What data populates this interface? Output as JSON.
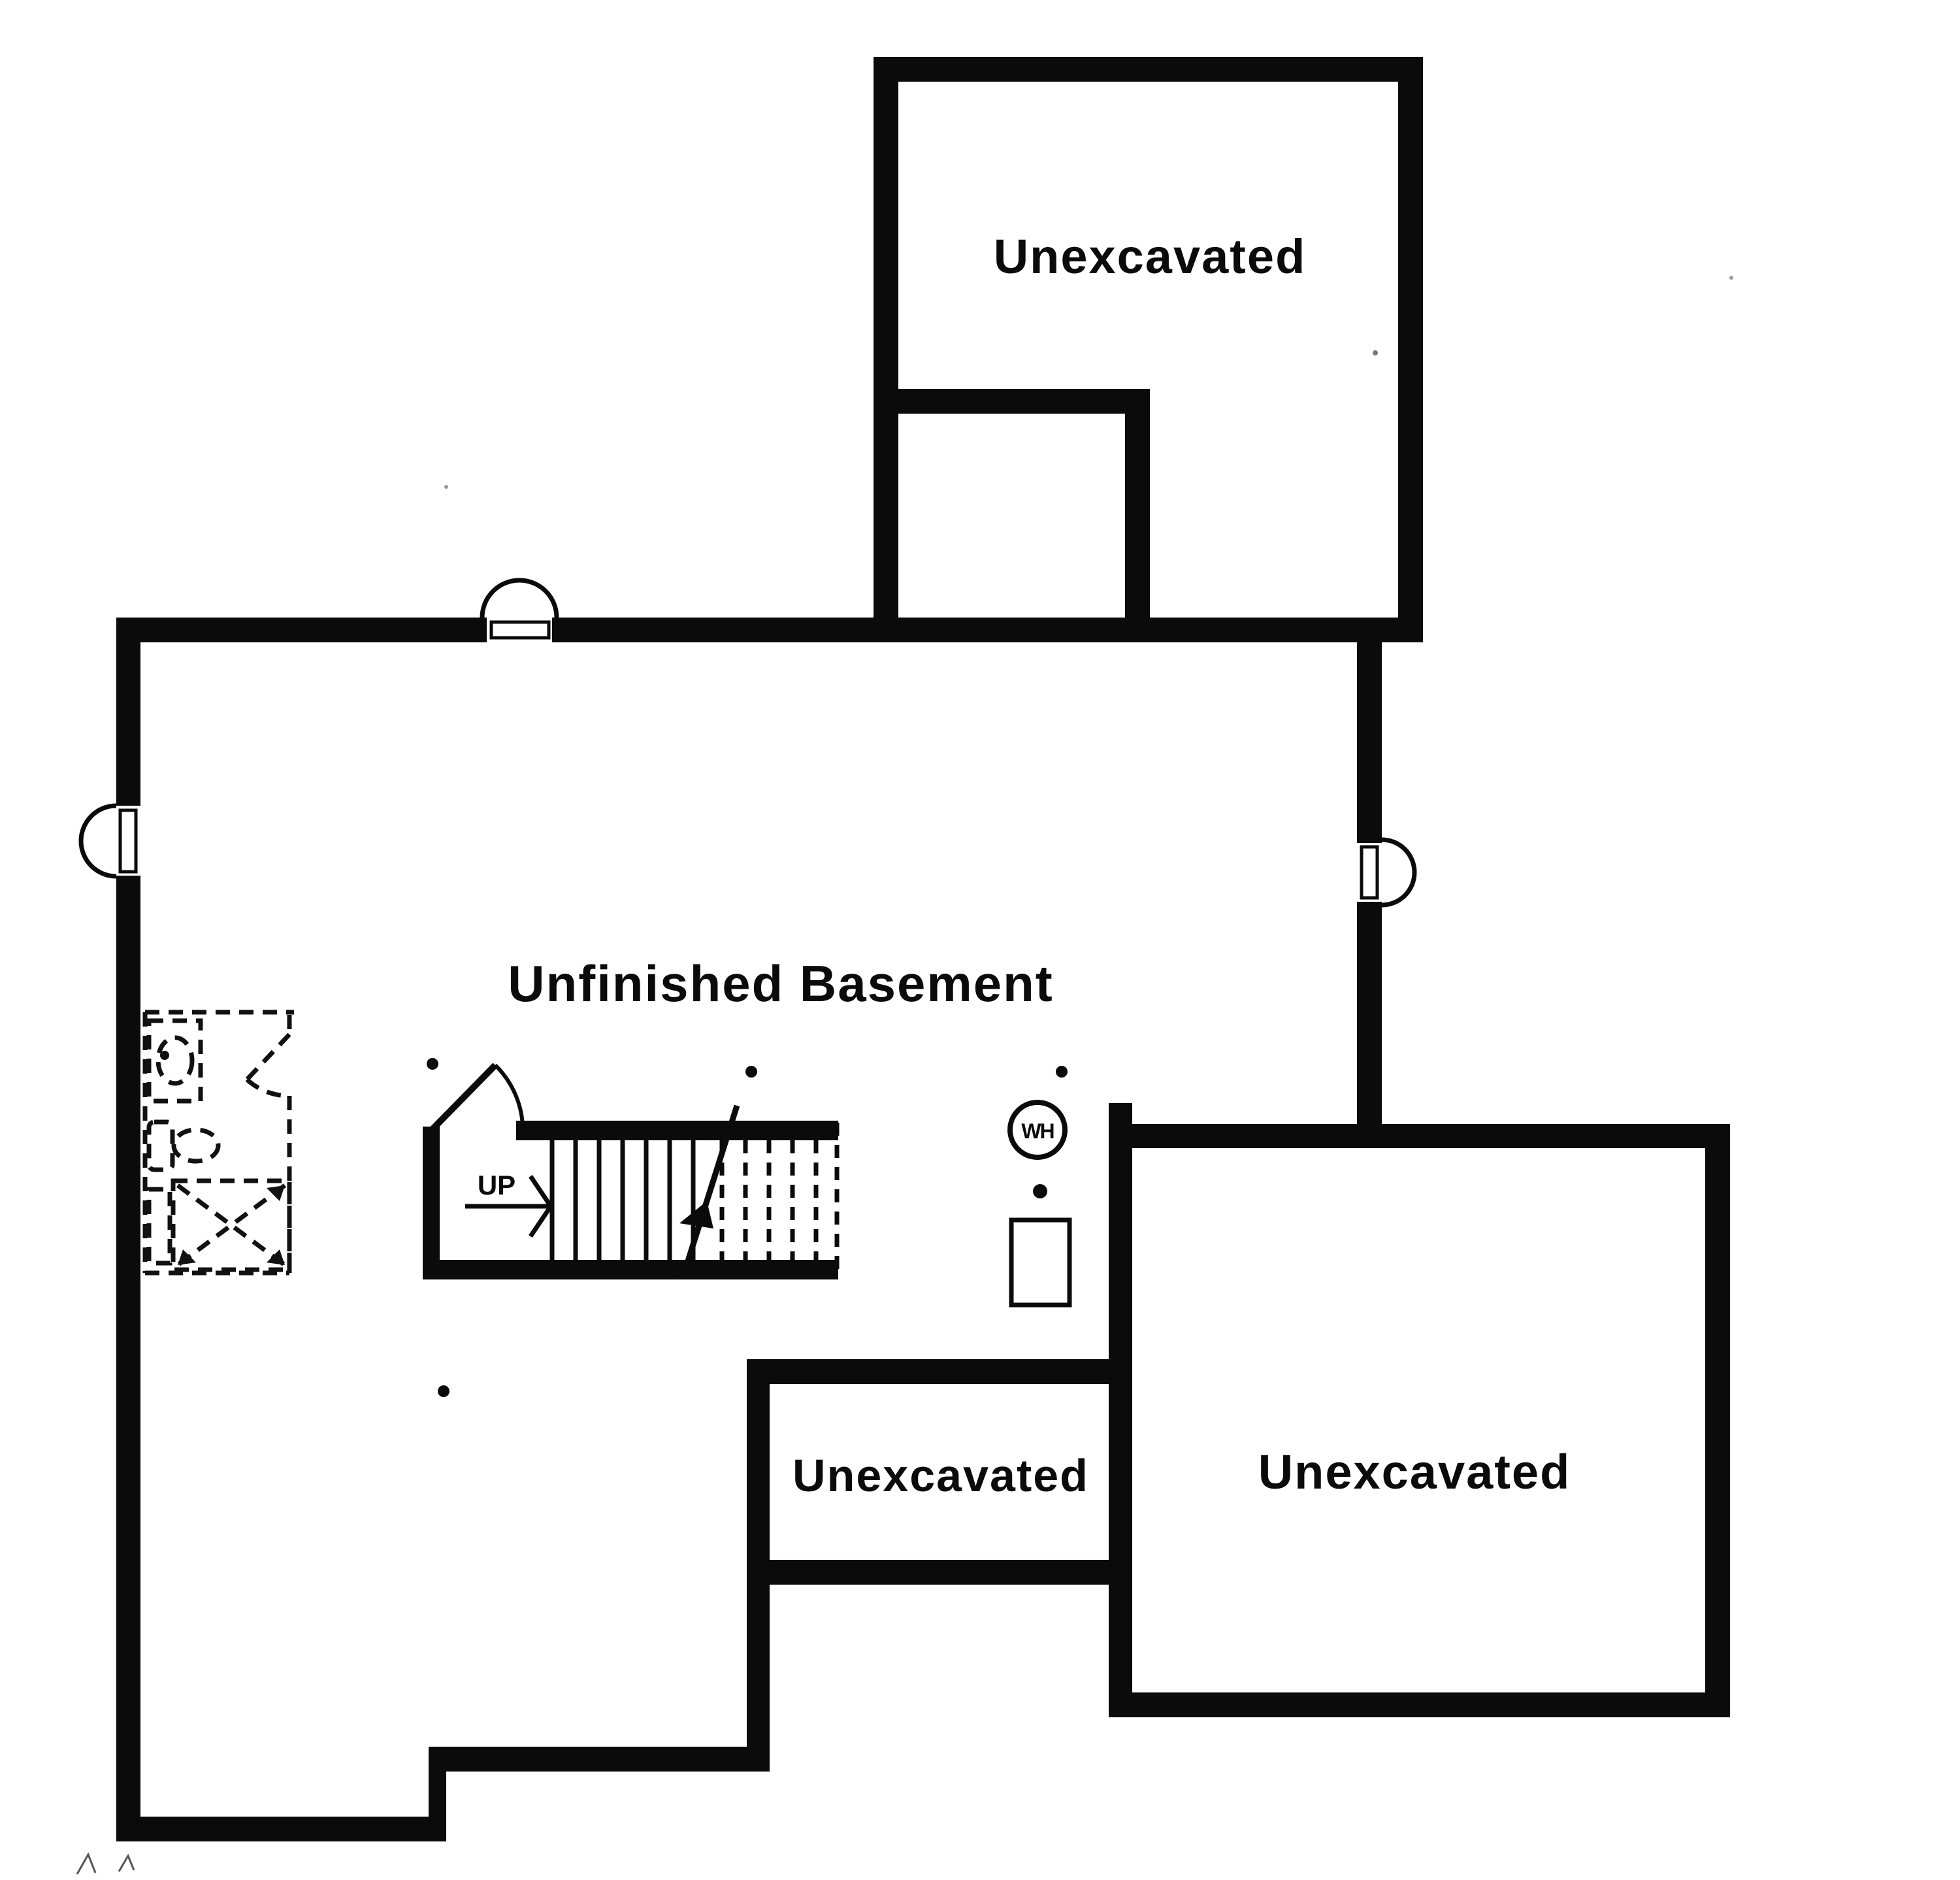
{
  "document": {
    "type": "basement floor plan",
    "background_color": "#ffffff",
    "wall_color": "#0b0b0b",
    "dashed_color": "#111111"
  },
  "rooms": {
    "top_unexcavated": {
      "label": "Unexcavated"
    },
    "main_basement": {
      "label": "Unfinished Basement"
    },
    "crawl_unexcavated": {
      "label": "Unexcavated"
    },
    "right_unexcavated": {
      "label": "Unexcavated"
    }
  },
  "stairs": {
    "up_label": "UP"
  },
  "equipment": {
    "water_heater_label": "WH",
    "water_heater_icon": "wh-circle",
    "furnace_icon": "furnace-rectangle",
    "floor_drain_icon": "filled-dot"
  },
  "symbols": {
    "window_icon": "window-well-arc",
    "post_icon": "column-dot",
    "bath_icons": [
      "sink-oval",
      "toilet",
      "shower-x-box",
      "door-swing-dashed"
    ]
  }
}
